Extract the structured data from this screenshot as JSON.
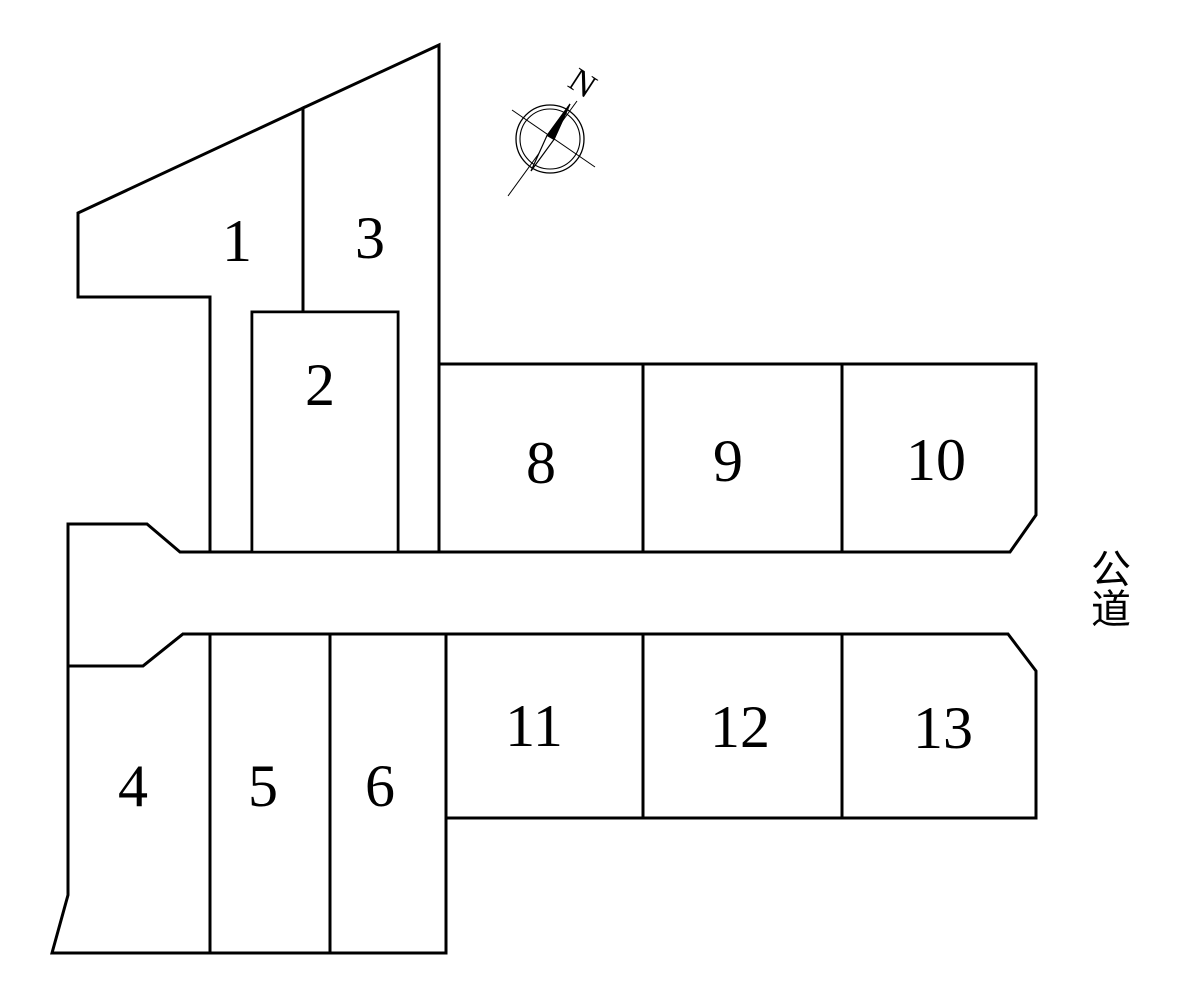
{
  "diagram": {
    "kind": "lot-subdivision-plan"
  },
  "lots": [
    {
      "number": "1"
    },
    {
      "number": "2"
    },
    {
      "number": "3"
    },
    {
      "number": "4"
    },
    {
      "number": "5"
    },
    {
      "number": "6"
    },
    {
      "number": "8"
    },
    {
      "number": "9"
    },
    {
      "number": "10"
    },
    {
      "number": "11"
    },
    {
      "number": "12"
    },
    {
      "number": "13"
    }
  ],
  "road": {
    "label": "公道"
  },
  "compass": {
    "north_label": "N"
  },
  "colors": {
    "line": "#000000",
    "background": "#ffffff",
    "needle_fill": "#000000"
  }
}
